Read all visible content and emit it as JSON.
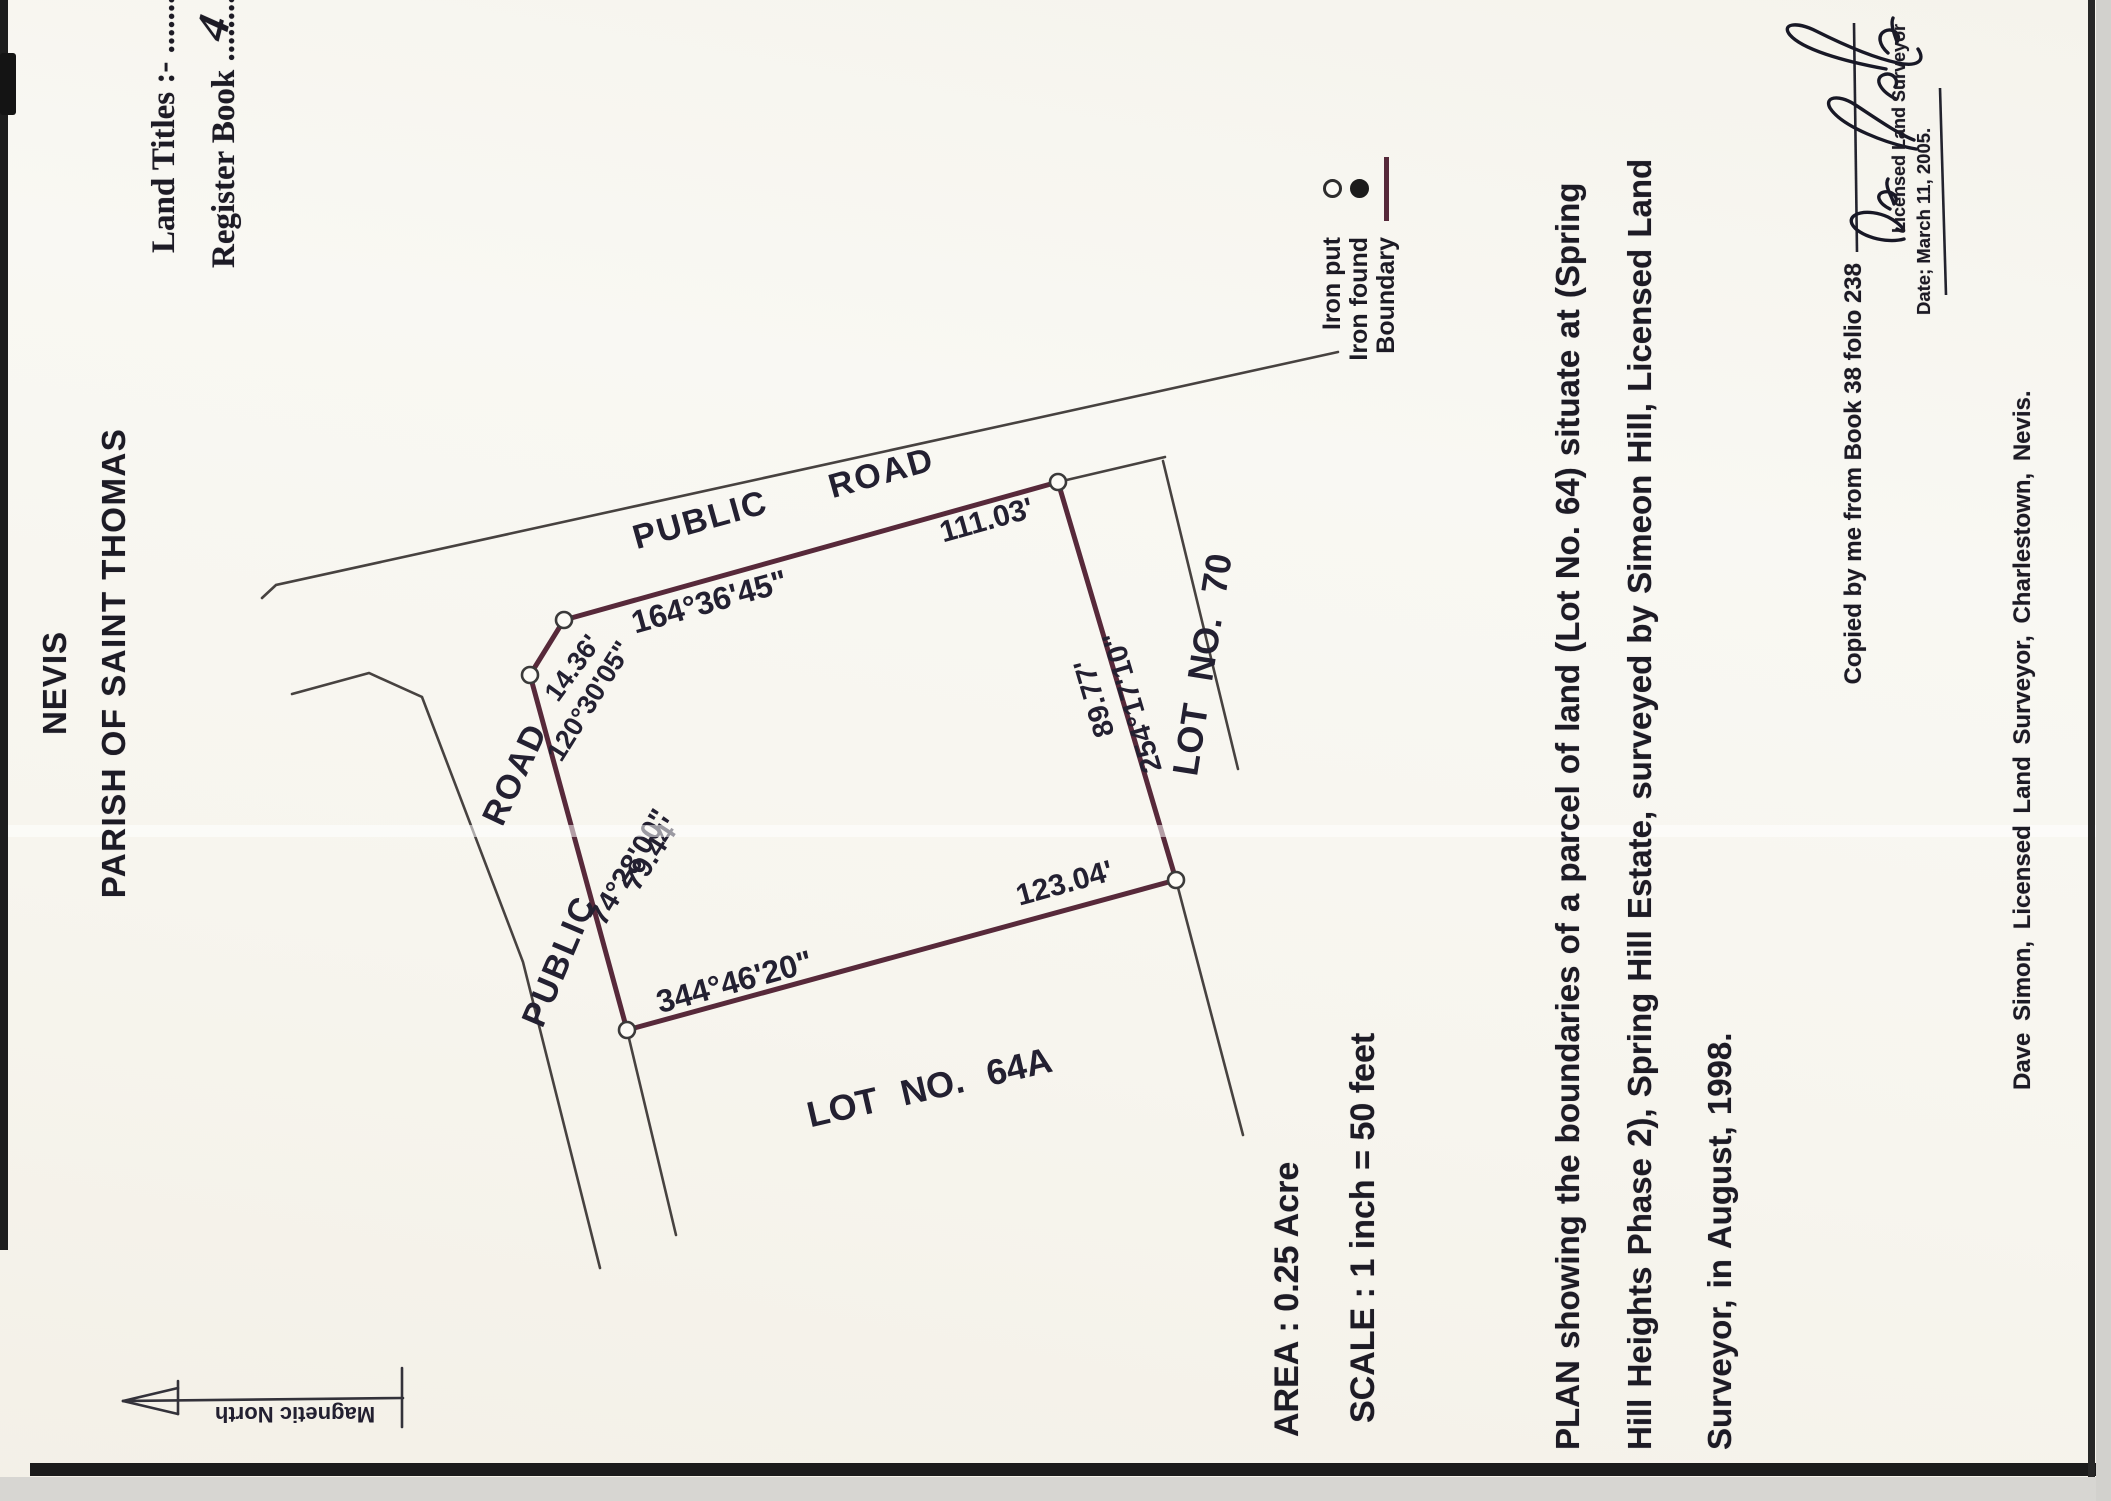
{
  "document": {
    "region": "NEVIS",
    "parish": "PARISH OF SAINT THOMAS",
    "land_titles_label": "Land Titles  :-  ........",
    "register_book_label": "Register Book .........",
    "register_book_entry": "4",
    "area_label": "AREA : 0.25 Acre",
    "scale_label": "SCALE : 1 inch = 50 feet",
    "description_line1": "PLAN showing the boundaries of a parcel of land (Lot  No. 64) situate at (Spring",
    "description_line2": "Hill Heights Phase 2), Spring Hill Estate, surveyed by Simeon Hill, Licensed Land",
    "description_line3": "Surveyor, in August, 1998.",
    "copied_note": "Copied by me from Book 38 folio 238",
    "signature_name": "Dave Simon",
    "licensed_title": "Licensed Land Surveyor",
    "date_line": "Date; March 11, 2005.",
    "footer_line": "Dave Simon,  Licensed Land Surveyor,  Charlestown,  Nevis.",
    "north_label": "Magnetic North"
  },
  "legend": {
    "items": [
      {
        "label": "Iron put",
        "symbol": "open-circle"
      },
      {
        "label": "Iron found",
        "symbol": "filled-circle"
      },
      {
        "label": "Boundary",
        "symbol": "boundary-line"
      }
    ]
  },
  "parcel": {
    "lot_number": "Lot No. 64",
    "area": "0.25 Acre",
    "scale": "1 inch = 50 feet",
    "neighbor_south": "LOT  NO.  64A",
    "neighbor_east": "LOT  NO.  70"
  },
  "diagram": {
    "colors": {
      "boundary": "#57293a",
      "thin_line": "#474240",
      "text": "#232031",
      "marker_fill": "#fcfbf6"
    },
    "labels": [
      {
        "name": "road-label-top-public",
        "text": "PUBLIC",
        "x": 979,
        "y": 701,
        "rot": 74.4,
        "size": 34,
        "ls": 2
      },
      {
        "name": "road-label-top-road",
        "text": "ROAD",
        "x": 1026,
        "y": 882,
        "rot": 74.4,
        "size": 34,
        "ls": 2
      },
      {
        "name": "dim-north-length",
        "text": "111.03'",
        "x": 979,
        "y": 987,
        "rot": 74.4,
        "size": 30
      },
      {
        "name": "bearing-north",
        "text": "164°36'45\"",
        "x": 897,
        "y": 710,
        "rot": 74.4,
        "size": 32
      },
      {
        "name": "dim-corner-length",
        "text": "14.36'",
        "x": 832,
        "y": 574,
        "rot": 36,
        "size": 27
      },
      {
        "name": "bearing-corner",
        "text": "120°30'05\"",
        "x": 799,
        "y": 591,
        "rot": 32,
        "size": 27
      },
      {
        "name": "bearing-west",
        "text": "74°28'00\"",
        "x": 633,
        "y": 631,
        "rot": 31,
        "size": 29
      },
      {
        "name": "dim-west-length",
        "text": "79.44'",
        "x": 646,
        "y": 653,
        "rot": 33,
        "size": 29
      },
      {
        "name": "road-label-west-road",
        "text": "ROAD",
        "x": 726,
        "y": 517,
        "rot": 25,
        "size": 34,
        "ls": 2
      },
      {
        "name": "road-label-west-public",
        "text": "PUBLIC",
        "x": 539,
        "y": 561,
        "rot": 23,
        "size": 34,
        "ls": 2
      },
      {
        "name": "dim-east-length",
        "text": "89.77'",
        "x": 803,
        "y": 1096,
        "rot": -16.5,
        "size": 29
      },
      {
        "name": "bearing-east",
        "text": "254°17'10\"",
        "x": 799,
        "y": 1134,
        "rot": -16.5,
        "size": 29
      },
      {
        "name": "dim-south-length",
        "text": "123.04'",
        "x": 616,
        "y": 1065,
        "rot": 74.7,
        "size": 30
      },
      {
        "name": "bearing-south",
        "text": "344°46'20\"",
        "x": 517,
        "y": 735,
        "rot": 74.7,
        "size": 32
      },
      {
        "name": "neighbor-lot-64a",
        "text": "LOT  NO.  64A",
        "x": 411,
        "y": 930,
        "rot": 77,
        "size": 36,
        "ws": 14
      },
      {
        "name": "neighbor-lot-70",
        "text": "LOT  NO.  70",
        "x": 836,
        "y": 1205,
        "rot": 9,
        "size": 36,
        "ws": 14
      },
      {
        "name": "magnetic-north-label",
        "text": "Magnetic North",
        "x": 88,
        "y": 295,
        "rot": -90,
        "size": 22
      }
    ]
  }
}
